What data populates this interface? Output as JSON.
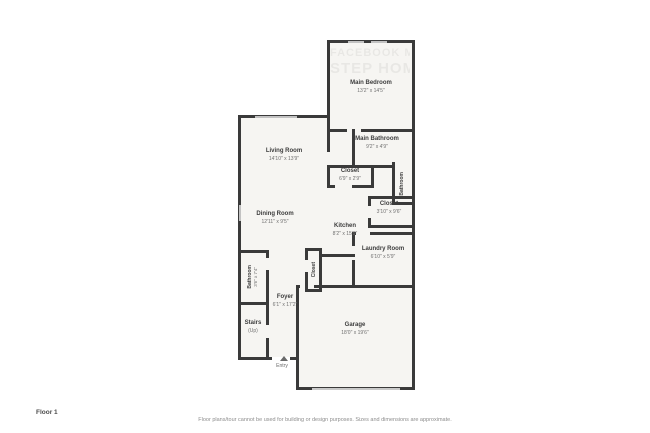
{
  "page": {
    "floor_label": "Floor 1",
    "disclaimer": "Floor plans/tour cannot be used for building or design purposes. Sizes and dimensions are approximate."
  },
  "watermark": {
    "line1": "FACEBOOK M",
    "line2": "STEP HOME"
  },
  "entry": {
    "label": "Entry"
  },
  "colors": {
    "wall": "#3a3a3a",
    "room_fill": "#f6f5f2",
    "window": "#c2c2c2",
    "name_text": "#3c3c3c",
    "dim_text": "#707070"
  },
  "rooms": {
    "main_bedroom": {
      "name": "Main Bedroom",
      "dims": "13'2\" x 14'5\""
    },
    "main_bathroom": {
      "name": "Main Bathroom",
      "dims": "9'2\" x 4'9\""
    },
    "bathroom_right": {
      "name": "Bathroom"
    },
    "closet_hall": {
      "name": "Closet",
      "dims": "6'9\" x 2'9\""
    },
    "closet_right": {
      "name": "Closet",
      "dims": "3'10\" x 9'6\""
    },
    "living_room": {
      "name": "Living Room",
      "dims": "14'10\" x 13'9\""
    },
    "dining_room": {
      "name": "Dining Room",
      "dims": "12'11\" x 9'5\""
    },
    "kitchen": {
      "name": "Kitchen",
      "dims": "8'2\" x 15'9\""
    },
    "laundry_room": {
      "name": "Laundry Room",
      "dims": "6'10\" x 5'9\""
    },
    "closet_small": {
      "name": "Closet"
    },
    "bathroom_left": {
      "name": "Bathroom",
      "dims": "3'6\" x 7'4\""
    },
    "foyer": {
      "name": "Foyer",
      "dims": "6'1\" x 17'2\""
    },
    "stairs": {
      "name": "Stairs",
      "dims": "(Up)"
    },
    "garage": {
      "name": "Garage",
      "dims": "18'0\" x 19'6\""
    }
  }
}
